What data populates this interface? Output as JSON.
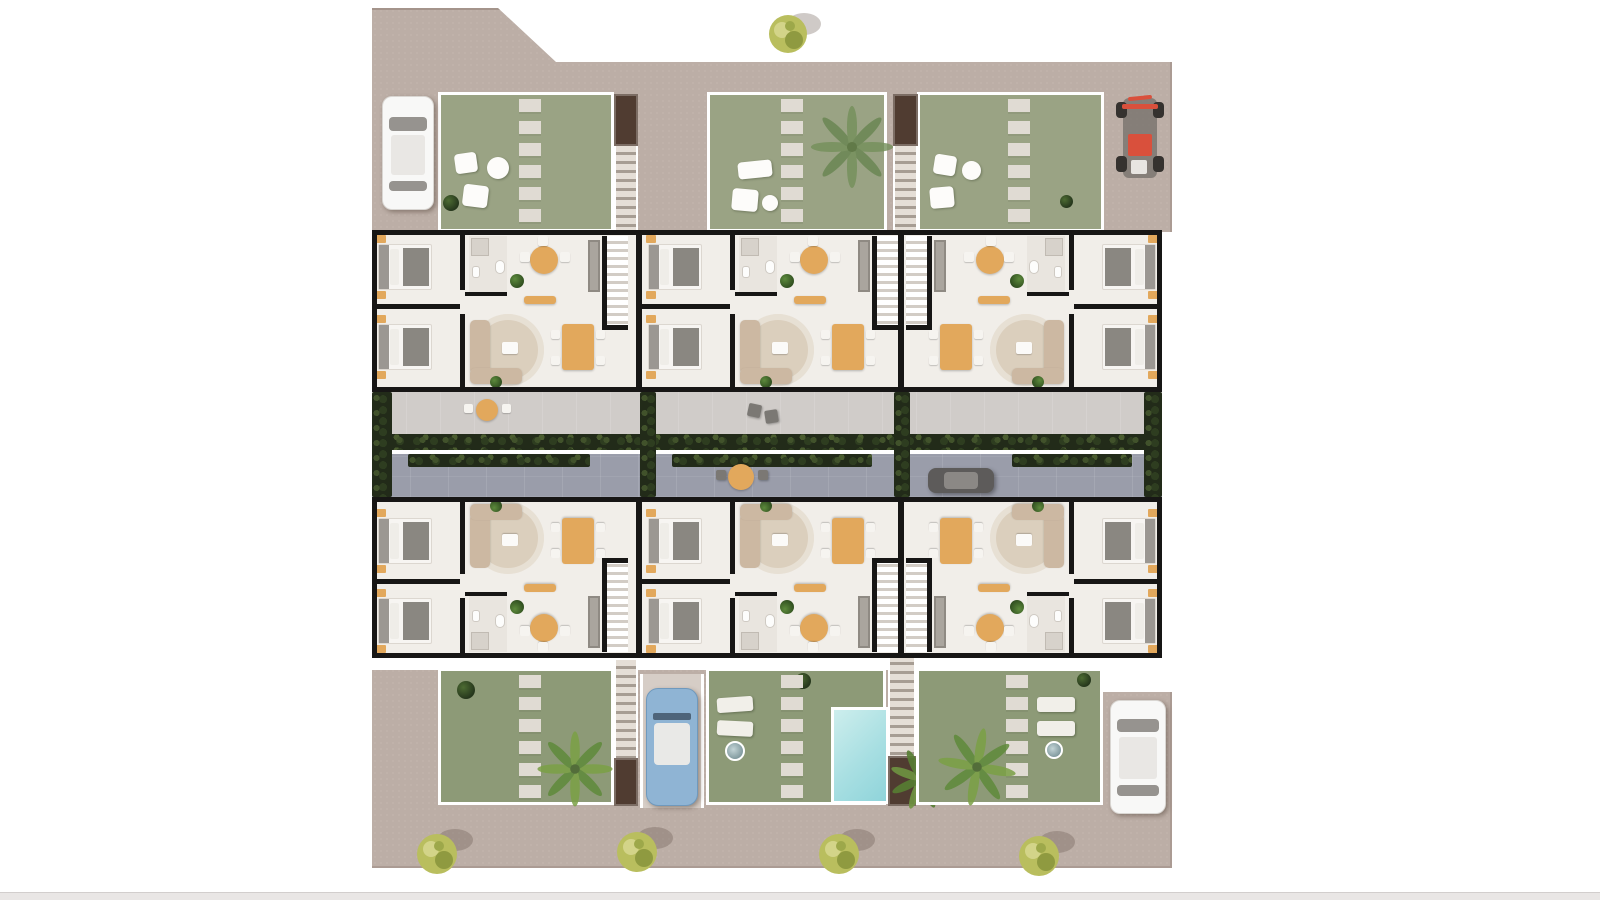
{
  "meta": {
    "kind": "architectural-site-plan",
    "description": "Top-down 3D rendered floor plan of a two-row residential complex: six apartment units around a central landscaped driveway, private gardens with stepping stones, exterior staircases, a swimming pool, parked vehicles and street trees on a beige ground plate."
  },
  "colors": {
    "plate": "#bcaea6",
    "walkway": "#d0ccc9",
    "road": "#9a9daa",
    "hedge": "#222b19",
    "wall": "#171615",
    "floor": "#f1eee9",
    "bath": "#e9e5df",
    "gardenTop": "#9aa384",
    "gardenBottom": "#8d9a77",
    "stone": "#e0dbd3",
    "poolLight": "#cdeeed",
    "poolDeep": "#8fd4da",
    "orange": "#e2a85c",
    "rug": "#dbcfbd",
    "sofa": "#ccb8a2",
    "duvet": "#f7f5f2",
    "blanket": "#8a8781",
    "headboard": "#9b9792",
    "treeLight": "#b9be5e",
    "treeDark": "#8f9a40",
    "palm": "#6f8c4a",
    "shaft": "#503c31",
    "grayCar": "#5d5b5a",
    "blueCar": "#8fb4d4",
    "whiteCar": "#f8f8f7",
    "quadRed": "#d9503c",
    "fence": "#ffffff",
    "bottomBar": "#e9e6e5"
  },
  "scene": {
    "units": [
      {
        "id": "slot-a1",
        "name": "apartment-unit-top-left",
        "mirror": false,
        "flip": false
      },
      {
        "id": "slot-b1",
        "name": "apartment-unit-top-center",
        "mirror": false,
        "flip": false
      },
      {
        "id": "slot-c1",
        "name": "apartment-unit-top-right",
        "mirror": true,
        "flip": false
      },
      {
        "id": "slot-a2",
        "name": "apartment-unit-bottom-left",
        "mirror": false,
        "flip": true
      },
      {
        "id": "slot-b2",
        "name": "apartment-unit-bottom-center",
        "mirror": false,
        "flip": true
      },
      {
        "id": "slot-c2",
        "name": "apartment-unit-bottom-right",
        "mirror": true,
        "flip": true
      }
    ],
    "vehicles": [
      "white-car-top-left",
      "red-quad-top-right",
      "gray-car-central-road",
      "blue-convertible-bottom",
      "white-car-bottom-right"
    ],
    "amenities": [
      "swimming-pool",
      "private-gardens",
      "exterior-staircases",
      "central-driveway",
      "terrace-walkway"
    ],
    "landscape": {
      "street_trees_bottom": 4,
      "street_tree_top": 1,
      "palm_trees": 4,
      "hedge_rows": 2
    }
  }
}
